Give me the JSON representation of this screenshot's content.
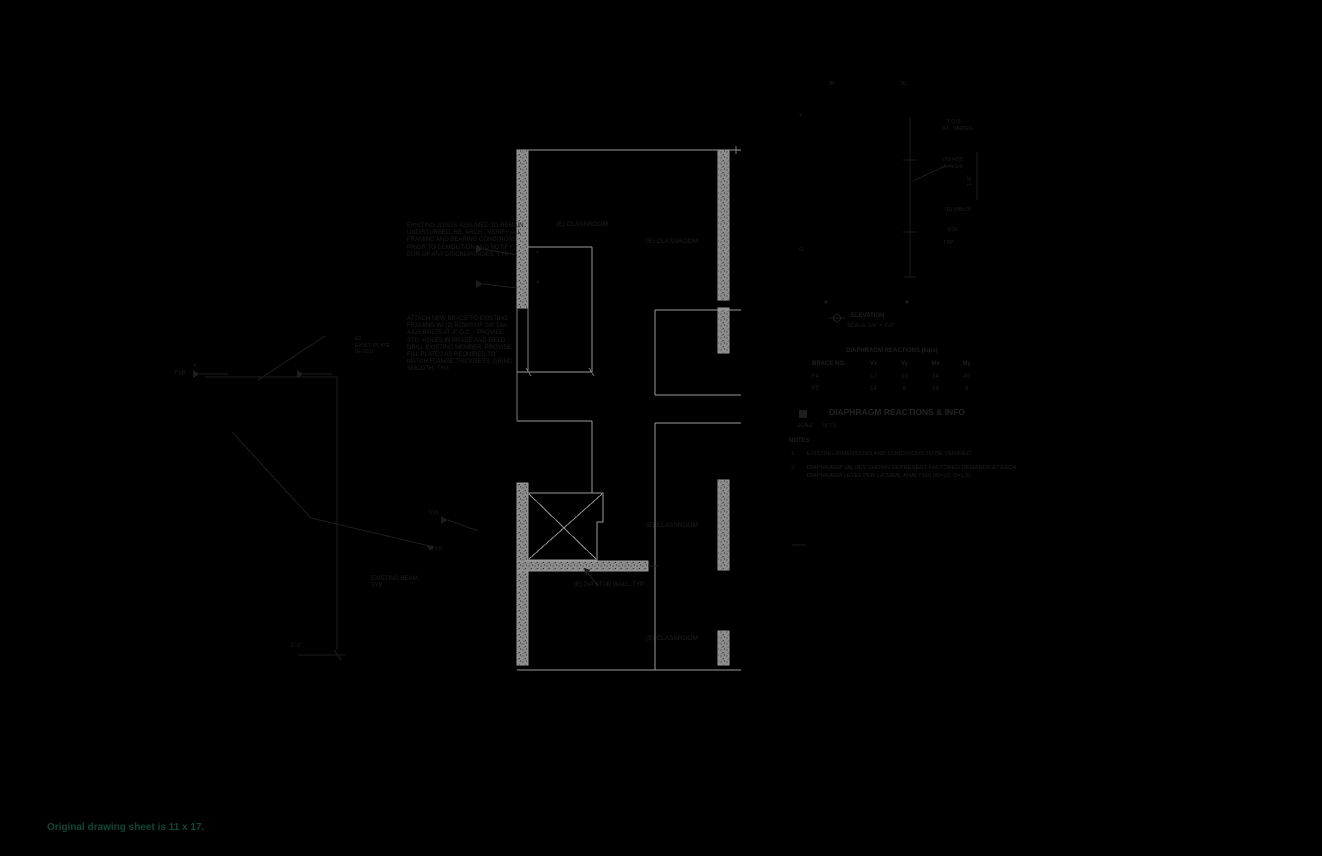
{
  "colors": {
    "background": "#000000",
    "wall_gray": "#8c8c8c",
    "line_gray": "#9a9a9a",
    "dark_annotation": "#1d1d1d",
    "caption_green": "#11463a"
  },
  "caption": {
    "text": "Original drawing sheet is 11 x 17."
  },
  "plan_labels": {
    "classroom_tl": "(E) CLASSROOM",
    "classroom_tr": "(E) CLASSROOM",
    "classroom_mr": "(E) CLASSROOM",
    "classroom_br": "(E) CLASSROOM",
    "stud_wall": "(E) 2x4 STUD WALL, TYP.",
    "existing_beam_1": "EXISTING BEAM,",
    "existing_beam_2": "TYP",
    "dim_3ft": "3'-0\"",
    "weld4_a": "4",
    "weld4_b": "4",
    "typ_left": "TYP",
    "weld4_left": "4",
    "weld316": "3/16",
    "typ_shaft": "TYP"
  },
  "left_notes": {
    "block1": [
      "EXISTING JOISTS ASSUMED TO REMAIN",
      "UNDISTURBED, RE: ARCH - VERIFY ALL",
      "FRAMING AND BEARING CONDITIONS",
      "PRIOR TO DEMOLITION AND NOTIFY",
      "EOR OF ANY DISCREPANCIES, TYP."
    ],
    "block2": [
      "ATTACH NEW BRACE TO EXISTING",
      "FRAMING W/ (2) ROWS OF 3/4\" DIA.",
      "A325 BOLTS AT 3\" O.C. - PROVIDE",
      "STD. HOLES IN BRACE AND FIELD",
      "DRILL EXISTING MEMBER. PROVIDE",
      "FILL PLATES AS REQUIRED TO",
      "MATCH FLANGE THICKNESS, GRIND",
      "SMOOTH, TYP."
    ],
    "tag": [
      "E2",
      "EXIST. PLATE",
      "(E-101)"
    ]
  },
  "elevation_detail": {
    "grid_a": "3B",
    "grid_b": "3C",
    "level_top": "Y",
    "level_bot": "G",
    "ann_tos": "T.O.S.",
    "ann_el": "EL. VARIES",
    "ann_hss1": "(N) HSS",
    "ann_hss2": "4x4x1/4",
    "ann_beam": "(E) W8x15",
    "ann_weld": "3/16",
    "ann_typ": "TYP",
    "ann_dim": "1'-6\"",
    "title": "ELEVATION",
    "scale": "SCALE: 1/4\" = 1'-0\""
  },
  "table": {
    "title": "DIAPHRAGM REACTIONS (kips)",
    "headers": [
      "BRACE NO.",
      "Vx",
      "Vy",
      "Mx",
      "My"
    ],
    "rows": [
      [
        "F4",
        "17",
        "13",
        "14",
        "40"
      ],
      [
        "F5",
        "14",
        "8",
        "14",
        "8"
      ]
    ]
  },
  "title_block": {
    "title": "DIAPHRAGM REACTIONS & INFO",
    "scale_label": "SCALE",
    "scale": "N.T.S.",
    "notes_heading": "NOTES",
    "note1_num": "1.",
    "note1_line1": "EXISTING DIMENSIONS AND CONDITIONS TO BE VERIFIED.",
    "note2_num": "2.",
    "note2_line1": "DIAPHRAGM VALUES SHOWN REPRESENT FACTORED DEMANDS AT EACH",
    "note2_line2": "DIAPHRAGM LEVEL PER LATERAL ANALYSIS (W=10, D=1.5)."
  }
}
